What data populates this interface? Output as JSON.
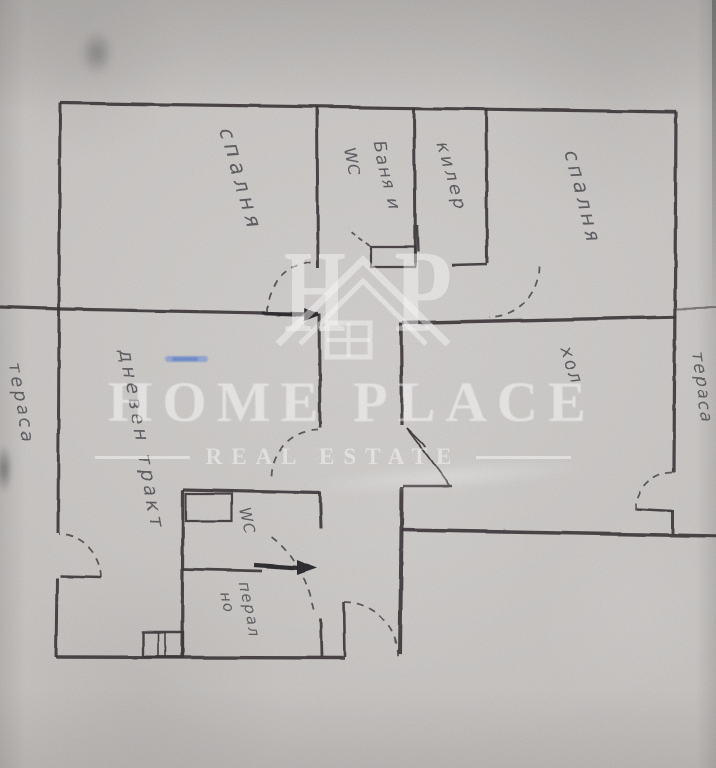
{
  "floorplan": {
    "rooms": [
      {
        "id": "bedroom-top-left",
        "label": "спалня"
      },
      {
        "id": "bathroom",
        "label_line1": "Баня и",
        "label_line2": "WC"
      },
      {
        "id": "closet",
        "label": "килер"
      },
      {
        "id": "bedroom-top-right",
        "label": "спалня"
      },
      {
        "id": "terrace-left",
        "label": "тераса"
      },
      {
        "id": "terrace-right",
        "label": "тераса"
      },
      {
        "id": "hall",
        "label": "хол"
      },
      {
        "id": "living-area",
        "label": "дневен тракт"
      },
      {
        "id": "wc",
        "label": "WC"
      },
      {
        "id": "laundry",
        "label_line1": "перал",
        "label_line2": "но"
      }
    ],
    "colors": {
      "paper": "#c6c3c1",
      "ink": "#332f31",
      "label_ink": "#46444b",
      "annotation_blue": "#7291d6",
      "watermark_white": "#ffffff"
    }
  },
  "watermark": {
    "brand": "HOME PLACE",
    "tagline": "REAL ESTATE",
    "monogram": {
      "h": "H",
      "p": "P"
    }
  }
}
